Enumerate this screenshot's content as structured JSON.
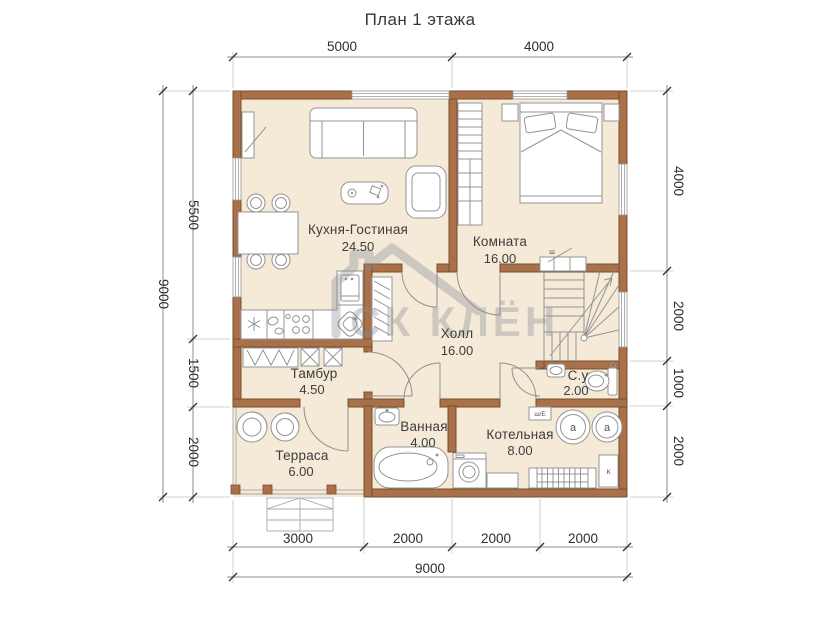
{
  "title": "План 1 этажа",
  "watermark": {
    "text": "СК КЛЁН"
  },
  "rooms": {
    "kitchen_living": {
      "name": "Кухня-Гостиная",
      "area": "24.50"
    },
    "bedroom": {
      "name": "Комната",
      "area": "16.00"
    },
    "hall": {
      "name": "Холл",
      "area": "16.00"
    },
    "tambour": {
      "name": "Тамбур",
      "area": "4.50"
    },
    "terrace": {
      "name": "Терраса",
      "area": "6.00"
    },
    "bathroom": {
      "name": "Ванная",
      "area": "4.00"
    },
    "boiler": {
      "name": "Котельная",
      "area": "8.00"
    },
    "wc": {
      "name": "С.у",
      "area": "2.00"
    }
  },
  "dimensions": {
    "top": [
      "5000",
      "4000"
    ],
    "left_inner": [
      "5500",
      "1500",
      "2000"
    ],
    "left_outer": "9000",
    "right": [
      "4000",
      "2000",
      "1000",
      "2000"
    ],
    "bottom_inner": [
      "3000",
      "2000",
      "2000",
      "2000"
    ],
    "bottom_outer": "9000"
  },
  "equipment_labels": {
    "tank": "a",
    "boiler_unit": "к",
    "meter_box": "ш/Е",
    "wardrobe_mark": "ш"
  },
  "colors": {
    "wall": "#a8714a",
    "wall_stroke": "#7a4f2b",
    "floor": "#f4ead7",
    "furniture_stroke": "#949494",
    "dimension_text": "#2e2e2e",
    "watermark": "#868d96"
  }
}
